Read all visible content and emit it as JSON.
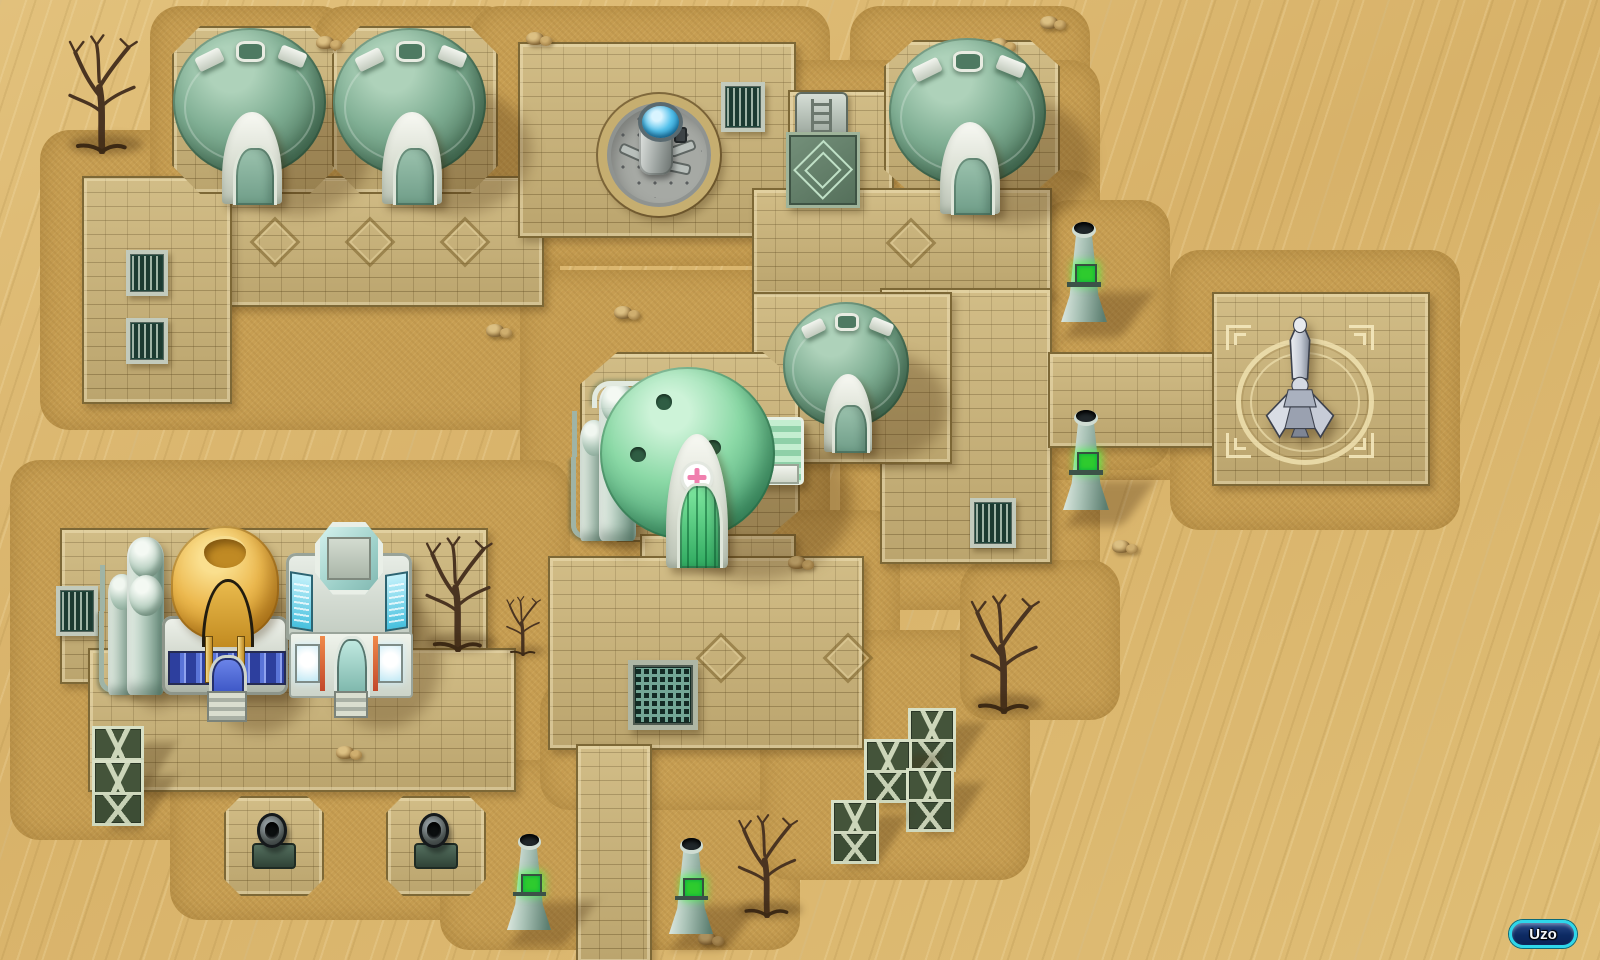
{
  "hud": {
    "location_label": "Uzo"
  },
  "palette": {
    "sand": "#dcba74",
    "dirt": "#c79e52",
    "pavement": "#c9b176",
    "pavement_edge": "#7d6836",
    "dome_green": "#7fae93",
    "dome_green_dark": "#3e6150",
    "clinic_green": "#8bd9a6",
    "trim_white": "#e7ebe2",
    "gold_dome": "#ecb94f",
    "tech_cyan": "#46c0de",
    "crate_green": "#44543a",
    "beacon_glow": "#2ecb2e",
    "water_blue": "#55c2ec",
    "cross_pink": "#f07fae",
    "badge_border": "#2ed7ea",
    "badge_fill": "#0d2a63",
    "badge_text": "#f4f7fb"
  },
  "map": {
    "ground_patches": [
      {
        "x": 40,
        "y": 130,
        "w": 520,
        "h": 300
      },
      {
        "x": 150,
        "y": 6,
        "w": 200,
        "h": 210
      },
      {
        "x": 315,
        "y": 6,
        "w": 200,
        "h": 210
      },
      {
        "x": 470,
        "y": 6,
        "w": 360,
        "h": 260
      },
      {
        "x": 850,
        "y": 6,
        "w": 240,
        "h": 220
      },
      {
        "x": 760,
        "y": 60,
        "w": 340,
        "h": 260
      },
      {
        "x": 840,
        "y": 170,
        "w": 260,
        "h": 440
      },
      {
        "x": 1010,
        "y": 320,
        "w": 230,
        "h": 160
      },
      {
        "x": 1170,
        "y": 250,
        "w": 290,
        "h": 280
      },
      {
        "x": 520,
        "y": 270,
        "w": 310,
        "h": 330
      },
      {
        "x": 500,
        "y": 510,
        "w": 400,
        "h": 290
      },
      {
        "x": 10,
        "y": 460,
        "w": 560,
        "h": 380
      },
      {
        "x": 170,
        "y": 740,
        "w": 330,
        "h": 180
      },
      {
        "x": 440,
        "y": 760,
        "w": 360,
        "h": 190
      },
      {
        "x": 540,
        "y": 680,
        "w": 350,
        "h": 130
      },
      {
        "x": 760,
        "y": 630,
        "w": 270,
        "h": 250
      },
      {
        "x": 960,
        "y": 560,
        "w": 160,
        "h": 160
      },
      {
        "x": 1040,
        "y": 200,
        "w": 130,
        "h": 270
      }
    ],
    "pavement": [
      {
        "name": "left-band",
        "x": 82,
        "y": 176,
        "w": 458,
        "h": 127,
        "shape": "rect"
      },
      {
        "name": "left-extension",
        "x": 82,
        "y": 176,
        "w": 146,
        "h": 224,
        "shape": "rect"
      },
      {
        "name": "dome1-platform",
        "x": 172,
        "y": 26,
        "w": 162,
        "h": 164,
        "shape": "octagon"
      },
      {
        "name": "dome2-platform",
        "x": 332,
        "y": 26,
        "w": 162,
        "h": 164,
        "shape": "octagon"
      },
      {
        "name": "top-plaza",
        "x": 518,
        "y": 42,
        "w": 274,
        "h": 192,
        "shape": "rect"
      },
      {
        "name": "teleporter-strip",
        "x": 788,
        "y": 90,
        "w": 102,
        "h": 144,
        "shape": "rect"
      },
      {
        "name": "right-dome-platform",
        "x": 884,
        "y": 40,
        "w": 172,
        "h": 152,
        "shape": "octagon"
      },
      {
        "name": "main-street-east",
        "x": 752,
        "y": 188,
        "w": 296,
        "h": 104,
        "shape": "rect"
      },
      {
        "name": "right-road-vertical",
        "x": 880,
        "y": 288,
        "w": 168,
        "h": 272,
        "shape": "rect"
      },
      {
        "name": "mid-dome-platform",
        "x": 752,
        "y": 292,
        "w": 196,
        "h": 168,
        "shape": "rect"
      },
      {
        "name": "clinic-platform",
        "x": 580,
        "y": 352,
        "w": 216,
        "h": 186,
        "shape": "octagon"
      },
      {
        "name": "clinic-south-strip",
        "x": 640,
        "y": 534,
        "w": 152,
        "h": 62,
        "shape": "rect"
      },
      {
        "name": "central-south-block",
        "x": 548,
        "y": 556,
        "w": 312,
        "h": 190,
        "shape": "rect"
      },
      {
        "name": "south-road",
        "x": 576,
        "y": 744,
        "w": 72,
        "h": 216,
        "shape": "rect"
      },
      {
        "name": "east-connector",
        "x": 1048,
        "y": 352,
        "w": 168,
        "h": 92,
        "shape": "rect"
      },
      {
        "name": "statue-plaza",
        "x": 1212,
        "y": 292,
        "w": 214,
        "h": 190,
        "shape": "rect"
      },
      {
        "name": "southwest-platform",
        "x": 60,
        "y": 528,
        "w": 424,
        "h": 152,
        "shape": "rect"
      },
      {
        "name": "southwest-apron",
        "x": 88,
        "y": 648,
        "w": 424,
        "h": 140,
        "shape": "rect"
      },
      {
        "name": "turret-pad-1",
        "x": 224,
        "y": 796,
        "w": 96,
        "h": 96,
        "shape": "octagon"
      },
      {
        "name": "turret-pad-2",
        "x": 386,
        "y": 796,
        "w": 96,
        "h": 96,
        "shape": "octagon"
      }
    ],
    "diamond_decals": [
      {
        "x": 257,
        "y": 224,
        "s": 30
      },
      {
        "x": 352,
        "y": 224,
        "s": 30
      },
      {
        "x": 447,
        "y": 224,
        "s": 30
      },
      {
        "x": 893,
        "y": 225,
        "s": 30
      },
      {
        "x": 703,
        "y": 640,
        "s": 30
      },
      {
        "x": 830,
        "y": 640,
        "s": 30
      }
    ],
    "rocks": [
      {
        "x": 526,
        "y": 28
      },
      {
        "x": 990,
        "y": 34
      },
      {
        "x": 316,
        "y": 32
      },
      {
        "x": 614,
        "y": 302
      },
      {
        "x": 486,
        "y": 320
      },
      {
        "x": 336,
        "y": 742
      },
      {
        "x": 918,
        "y": 744
      },
      {
        "x": 788,
        "y": 552
      },
      {
        "x": 1112,
        "y": 536
      },
      {
        "x": 698,
        "y": 928
      },
      {
        "x": 1040,
        "y": 12
      }
    ],
    "entities": [
      {
        "type": "tree",
        "name": "dead-tree-northwest",
        "x": 58,
        "y": 34,
        "w": 88,
        "h": 120,
        "interactable": false
      },
      {
        "type": "dome_house",
        "name": "dome-house-1",
        "x": 170,
        "y": 28,
        "w": 164,
        "h": 176,
        "interactable": true
      },
      {
        "type": "dome_house",
        "name": "dome-house-2",
        "x": 330,
        "y": 28,
        "w": 164,
        "h": 176,
        "interactable": true
      },
      {
        "type": "dome_house",
        "name": "dome-house-northeast",
        "x": 886,
        "y": 38,
        "w": 168,
        "h": 176,
        "interactable": true
      },
      {
        "type": "fountain",
        "name": "well-machine",
        "x": 598,
        "y": 94,
        "w": 122,
        "h": 122,
        "interactable": true
      },
      {
        "type": "vent",
        "name": "vent-grate-plaza",
        "x": 721,
        "y": 82,
        "w": 36,
        "h": 42,
        "interactable": false
      },
      {
        "type": "teleporter",
        "name": "teleporter-pad",
        "x": 786,
        "y": 92,
        "w": 68,
        "h": 110,
        "interactable": true
      },
      {
        "type": "vent",
        "name": "vent-grate-west-1",
        "x": 126,
        "y": 250,
        "w": 34,
        "h": 38,
        "interactable": false
      },
      {
        "type": "vent",
        "name": "vent-grate-west-2",
        "x": 126,
        "y": 318,
        "w": 34,
        "h": 38,
        "interactable": false
      },
      {
        "type": "beacon",
        "name": "beacon-tower-1",
        "x": 1058,
        "y": 222,
        "w": 52,
        "h": 100,
        "interactable": false
      },
      {
        "type": "shrine",
        "name": "statue-shrine",
        "x": 1218,
        "y": 306,
        "w": 164,
        "h": 162,
        "interactable": true
      },
      {
        "type": "dome_house",
        "name": "dome-house-center",
        "x": 780,
        "y": 302,
        "w": 136,
        "h": 150,
        "interactable": true
      },
      {
        "type": "silo",
        "name": "silo-tanks-clinic",
        "x": 580,
        "y": 378,
        "w": 64,
        "h": 168,
        "interactable": false
      },
      {
        "type": "clinic",
        "name": "clinic-dome",
        "x": 598,
        "y": 356,
        "w": 206,
        "h": 212,
        "interactable": true
      },
      {
        "type": "beacon",
        "name": "beacon-tower-2",
        "x": 1060,
        "y": 410,
        "w": 52,
        "h": 100,
        "interactable": false
      },
      {
        "type": "vent",
        "name": "vent-grate-east",
        "x": 970,
        "y": 498,
        "w": 38,
        "h": 42,
        "interactable": false
      },
      {
        "type": "grate",
        "name": "floor-grate-large",
        "x": 628,
        "y": 660,
        "w": 60,
        "h": 60,
        "interactable": false
      },
      {
        "type": "vent",
        "name": "vent-grate-southwest",
        "x": 56,
        "y": 586,
        "w": 34,
        "h": 42,
        "interactable": false
      },
      {
        "type": "silo",
        "name": "silo-tanks-southwest",
        "x": 108,
        "y": 532,
        "w": 64,
        "h": 168,
        "interactable": false
      },
      {
        "type": "gold_dome",
        "name": "gold-dome-building",
        "x": 162,
        "y": 526,
        "w": 126,
        "h": 196,
        "interactable": true
      },
      {
        "type": "tech_building",
        "name": "tech-building",
        "x": 286,
        "y": 522,
        "w": 126,
        "h": 196,
        "interactable": true
      },
      {
        "type": "tree",
        "name": "dead-tree-west",
        "x": 416,
        "y": 536,
        "w": 84,
        "h": 116,
        "interactable": false
      },
      {
        "type": "tree",
        "name": "dead-shrub-small",
        "x": 500,
        "y": 596,
        "w": 46,
        "h": 60,
        "interactable": false
      },
      {
        "type": "tree",
        "name": "dead-tree-east",
        "x": 964,
        "y": 592,
        "w": 80,
        "h": 122,
        "interactable": false
      },
      {
        "type": "crate",
        "name": "crate-1",
        "x": 908,
        "y": 708,
        "w": 42,
        "h": 58,
        "interactable": false
      },
      {
        "type": "crate",
        "name": "crate-2",
        "x": 864,
        "y": 739,
        "w": 42,
        "h": 58,
        "interactable": false
      },
      {
        "type": "crate",
        "name": "crate-3",
        "x": 906,
        "y": 768,
        "w": 42,
        "h": 58,
        "interactable": false
      },
      {
        "type": "crate",
        "name": "crate-4",
        "x": 831,
        "y": 800,
        "w": 42,
        "h": 58,
        "interactable": false
      },
      {
        "type": "crate",
        "name": "crate-stack-top",
        "x": 92,
        "y": 726,
        "w": 46,
        "h": 60,
        "interactable": false
      },
      {
        "type": "crate",
        "name": "crate-stack-bottom",
        "x": 92,
        "y": 760,
        "w": 46,
        "h": 60,
        "interactable": false
      },
      {
        "type": "turret",
        "name": "cannon-turret-1",
        "x": 250,
        "y": 812,
        "w": 44,
        "h": 56,
        "interactable": false
      },
      {
        "type": "turret",
        "name": "cannon-turret-2",
        "x": 412,
        "y": 812,
        "w": 44,
        "h": 56,
        "interactable": false
      },
      {
        "type": "beacon",
        "name": "beacon-tower-3",
        "x": 504,
        "y": 834,
        "w": 50,
        "h": 96,
        "interactable": false
      },
      {
        "type": "beacon",
        "name": "beacon-tower-4",
        "x": 666,
        "y": 838,
        "w": 50,
        "h": 96,
        "interactable": false
      },
      {
        "type": "tree",
        "name": "dead-tree-south",
        "x": 730,
        "y": 814,
        "w": 74,
        "h": 104,
        "interactable": false
      }
    ]
  }
}
